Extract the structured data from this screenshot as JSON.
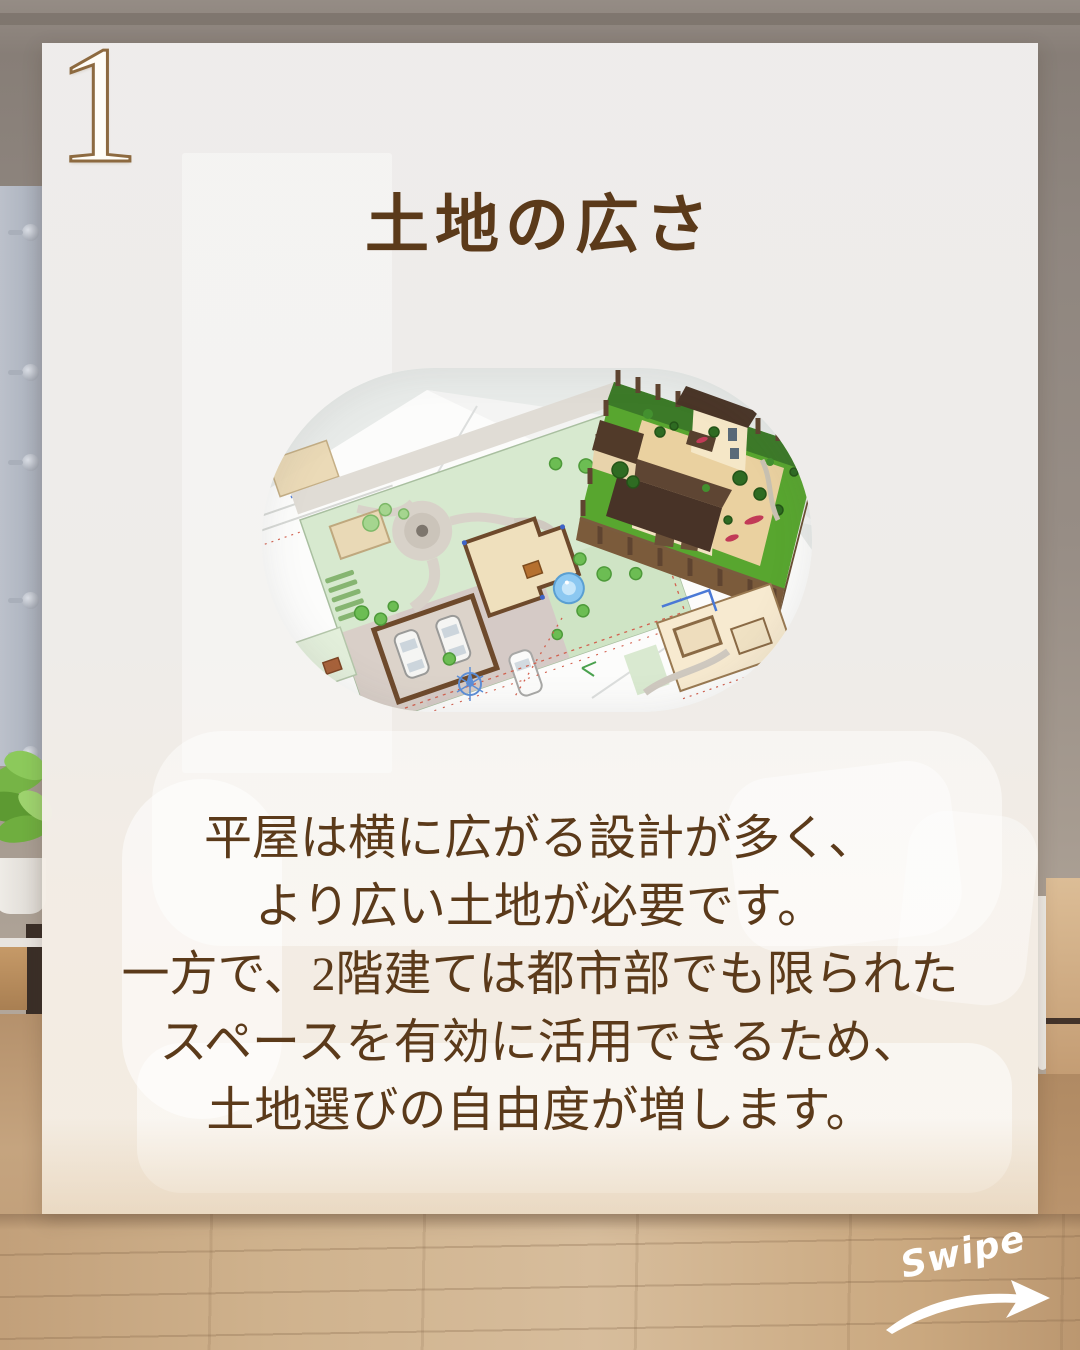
{
  "slide": {
    "number": "1",
    "title": "土地の広さ",
    "body_lines": [
      "平屋は横に広がる設計が多く、",
      "より広い土地が必要です。",
      "一方で、2階建ては都市部でも限られた",
      "スペースを有効に活用できるため、",
      "土地選びの自由度が増します。"
    ],
    "swipe_label": "Swipe",
    "image": {
      "alt": "敷地図面と住宅3D模型のイラスト"
    },
    "colors": {
      "text-brown": "#5b3a1a",
      "number-outline": "#8d6a40",
      "number-fill": "#fffdf7",
      "swipe-white": "#ffffff",
      "card-bg": "#f2f0ee"
    }
  }
}
